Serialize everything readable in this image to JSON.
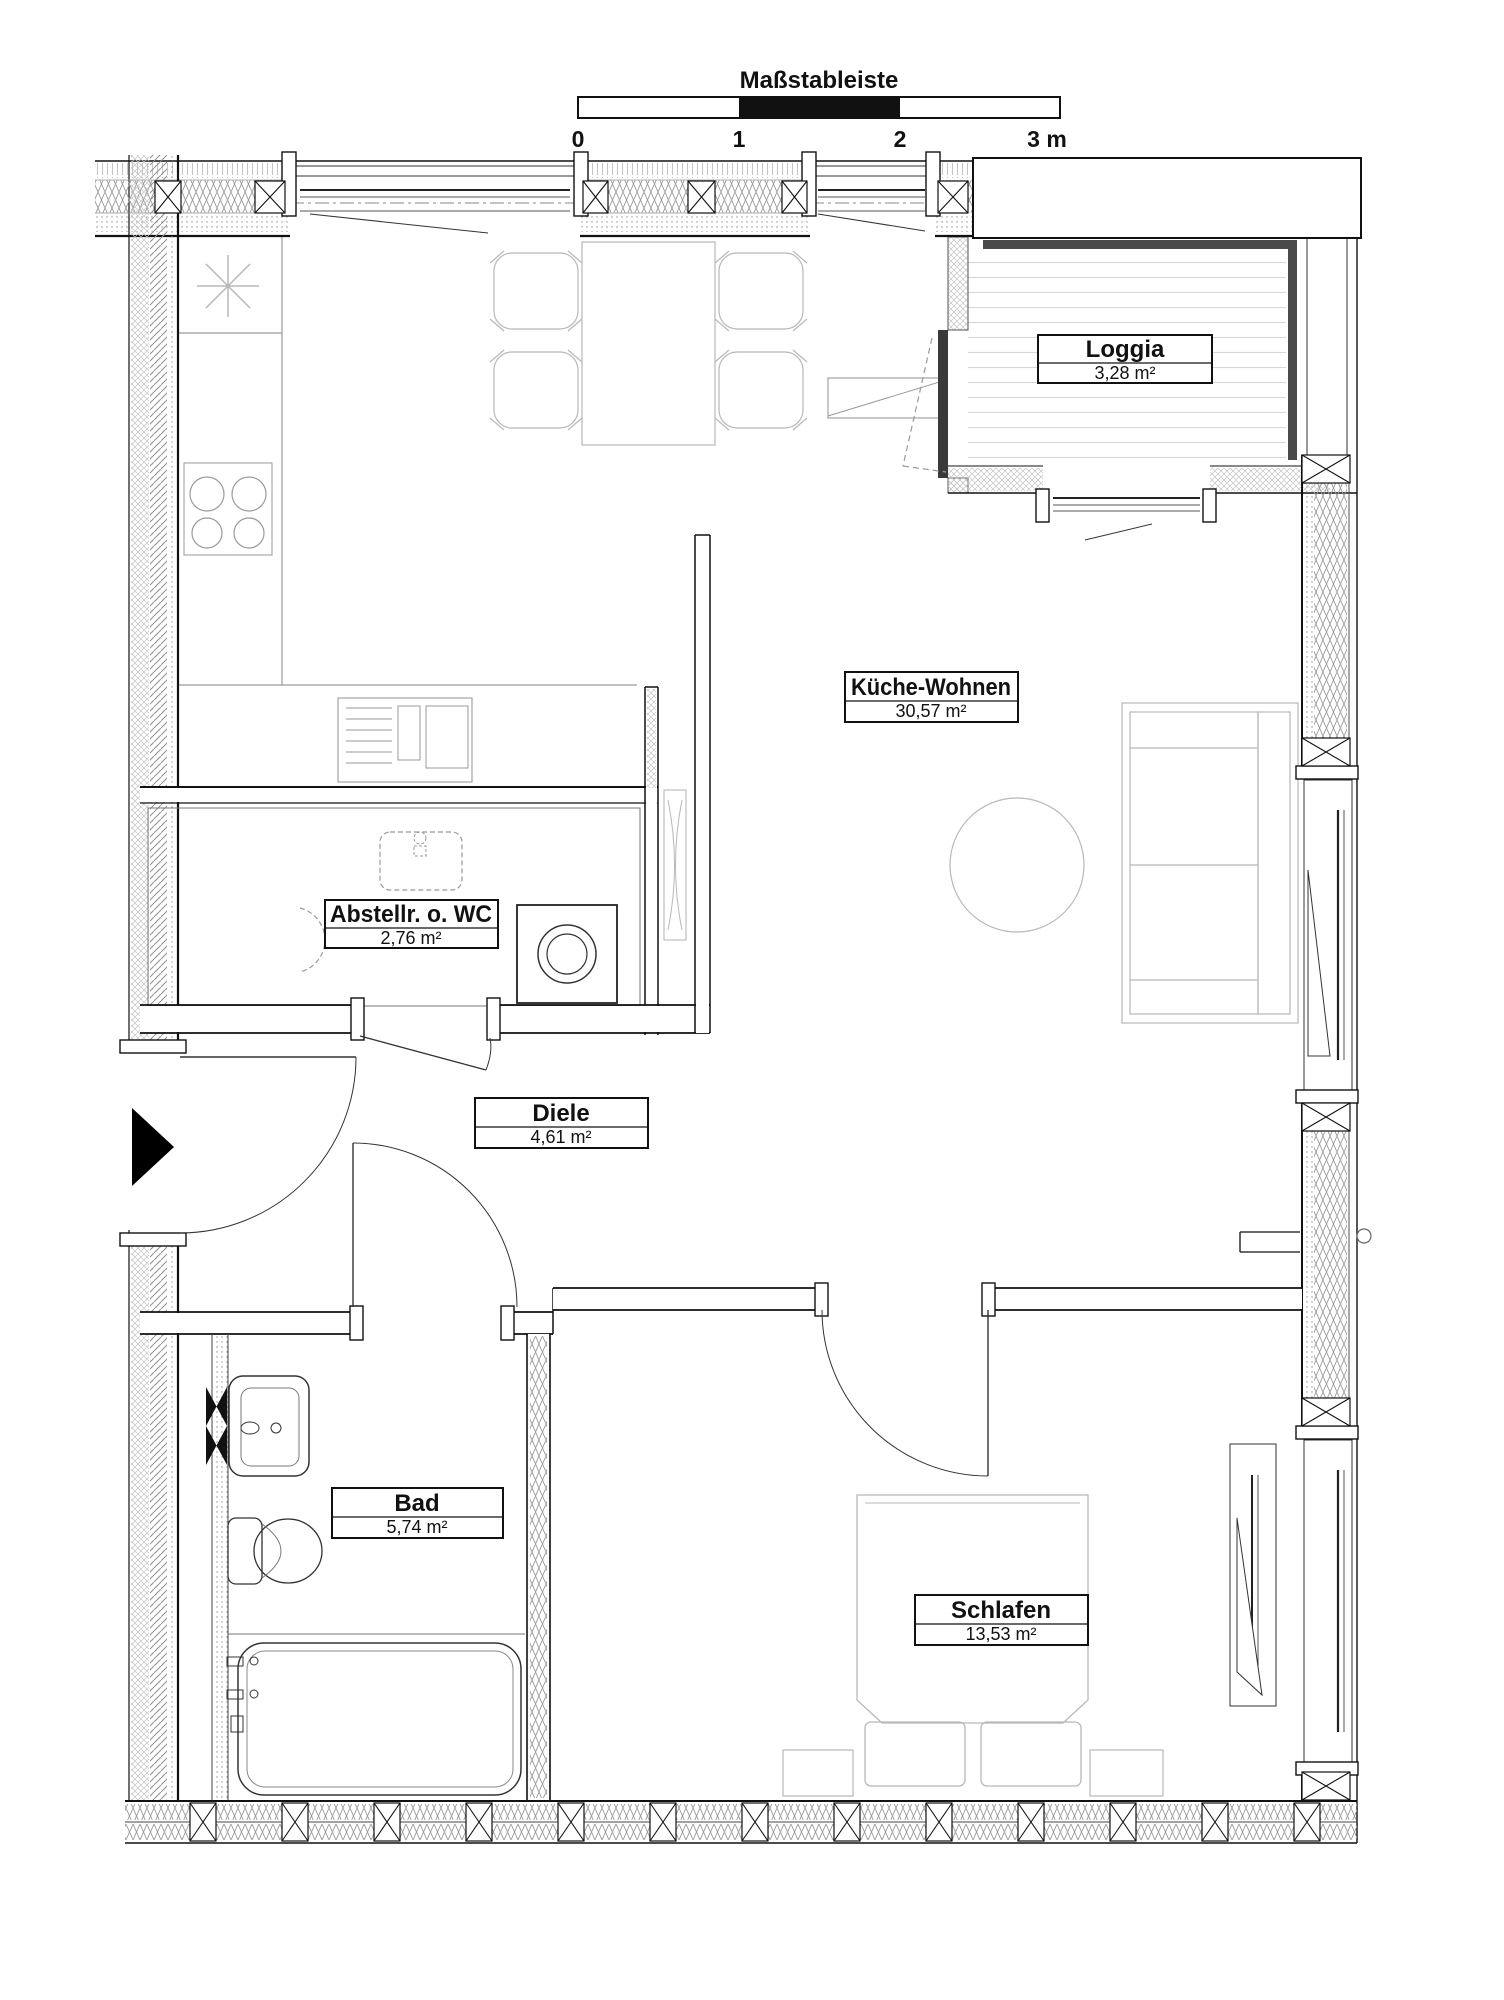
{
  "scalebar": {
    "title": "Maßstableiste",
    "ticks": [
      "0",
      "1",
      "2",
      "3 m"
    ]
  },
  "rooms": [
    {
      "id": "loggia",
      "name": "Loggia",
      "area": "3,28 m²"
    },
    {
      "id": "kueche-wohnen",
      "name": "Küche-Wohnen",
      "area": "30,57 m²"
    },
    {
      "id": "abstellraum",
      "name": "Abstellr. o. WC",
      "area": "2,76 m²"
    },
    {
      "id": "diele",
      "name": "Diele",
      "area": "4,61 m²"
    },
    {
      "id": "bad",
      "name": "Bad",
      "area": "5,74 m²"
    },
    {
      "id": "schlafen",
      "name": "Schlafen",
      "area": "13,53 m²"
    }
  ],
  "colors": {
    "wall_line": "#111111",
    "furniture_line": "#b8b8b8",
    "loggia_rail": "#4a4a4a",
    "scalebar_fill": "#111111",
    "background": "#ffffff"
  }
}
